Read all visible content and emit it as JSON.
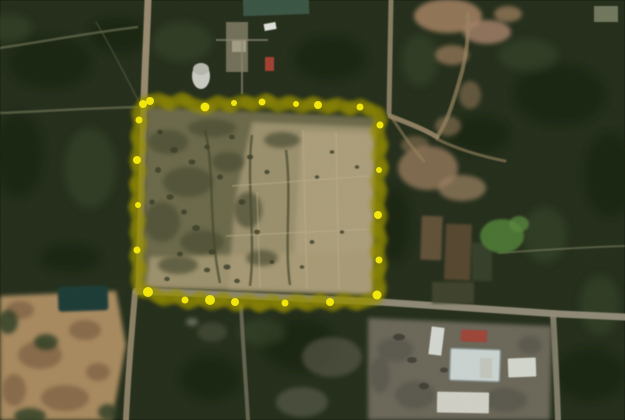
{
  "scene": {
    "type": "satellite-aerial-imagery",
    "description": "Low-resolution satellite photo of a cleared land parcel outlined with a hand-drawn yellow highlighter boundary, surrounded by dark forest, dirt roads, farm plots, a pond, and building compounds",
    "annotation": {
      "label": "parcel-boundary-highlight",
      "style": "hand-drawn-highlighter-scribble",
      "color": "#e8dd05",
      "glow_color": "#968e00",
      "highlight_color": "#fdf83e",
      "blob_color": "#f2e70a",
      "bounds_px": {
        "left": 136,
        "top": 99,
        "right": 382,
        "bottom": 301
      }
    },
    "palette": {
      "forest_dark": "#232d1a",
      "forest_shadow": "#18200f",
      "forest_light": "#39462a",
      "parcel_olive": "#6b684a",
      "parcel_tan": "#a39673",
      "parcel_tan_light": "#ad9f7c",
      "sand": "#a8895f",
      "sand_pink": "#9b7b5c",
      "road_tan": "#a49478",
      "road_gray": "#9a9280",
      "building_white": "#d2d6cf",
      "roof_green": "#3a5544",
      "roof_red": "#a33f32",
      "field_brown": "#6b553c",
      "water_dark": "#1f3b34",
      "grass_green": "#4c7a33",
      "compound_gray": "#6e6b5c"
    }
  }
}
